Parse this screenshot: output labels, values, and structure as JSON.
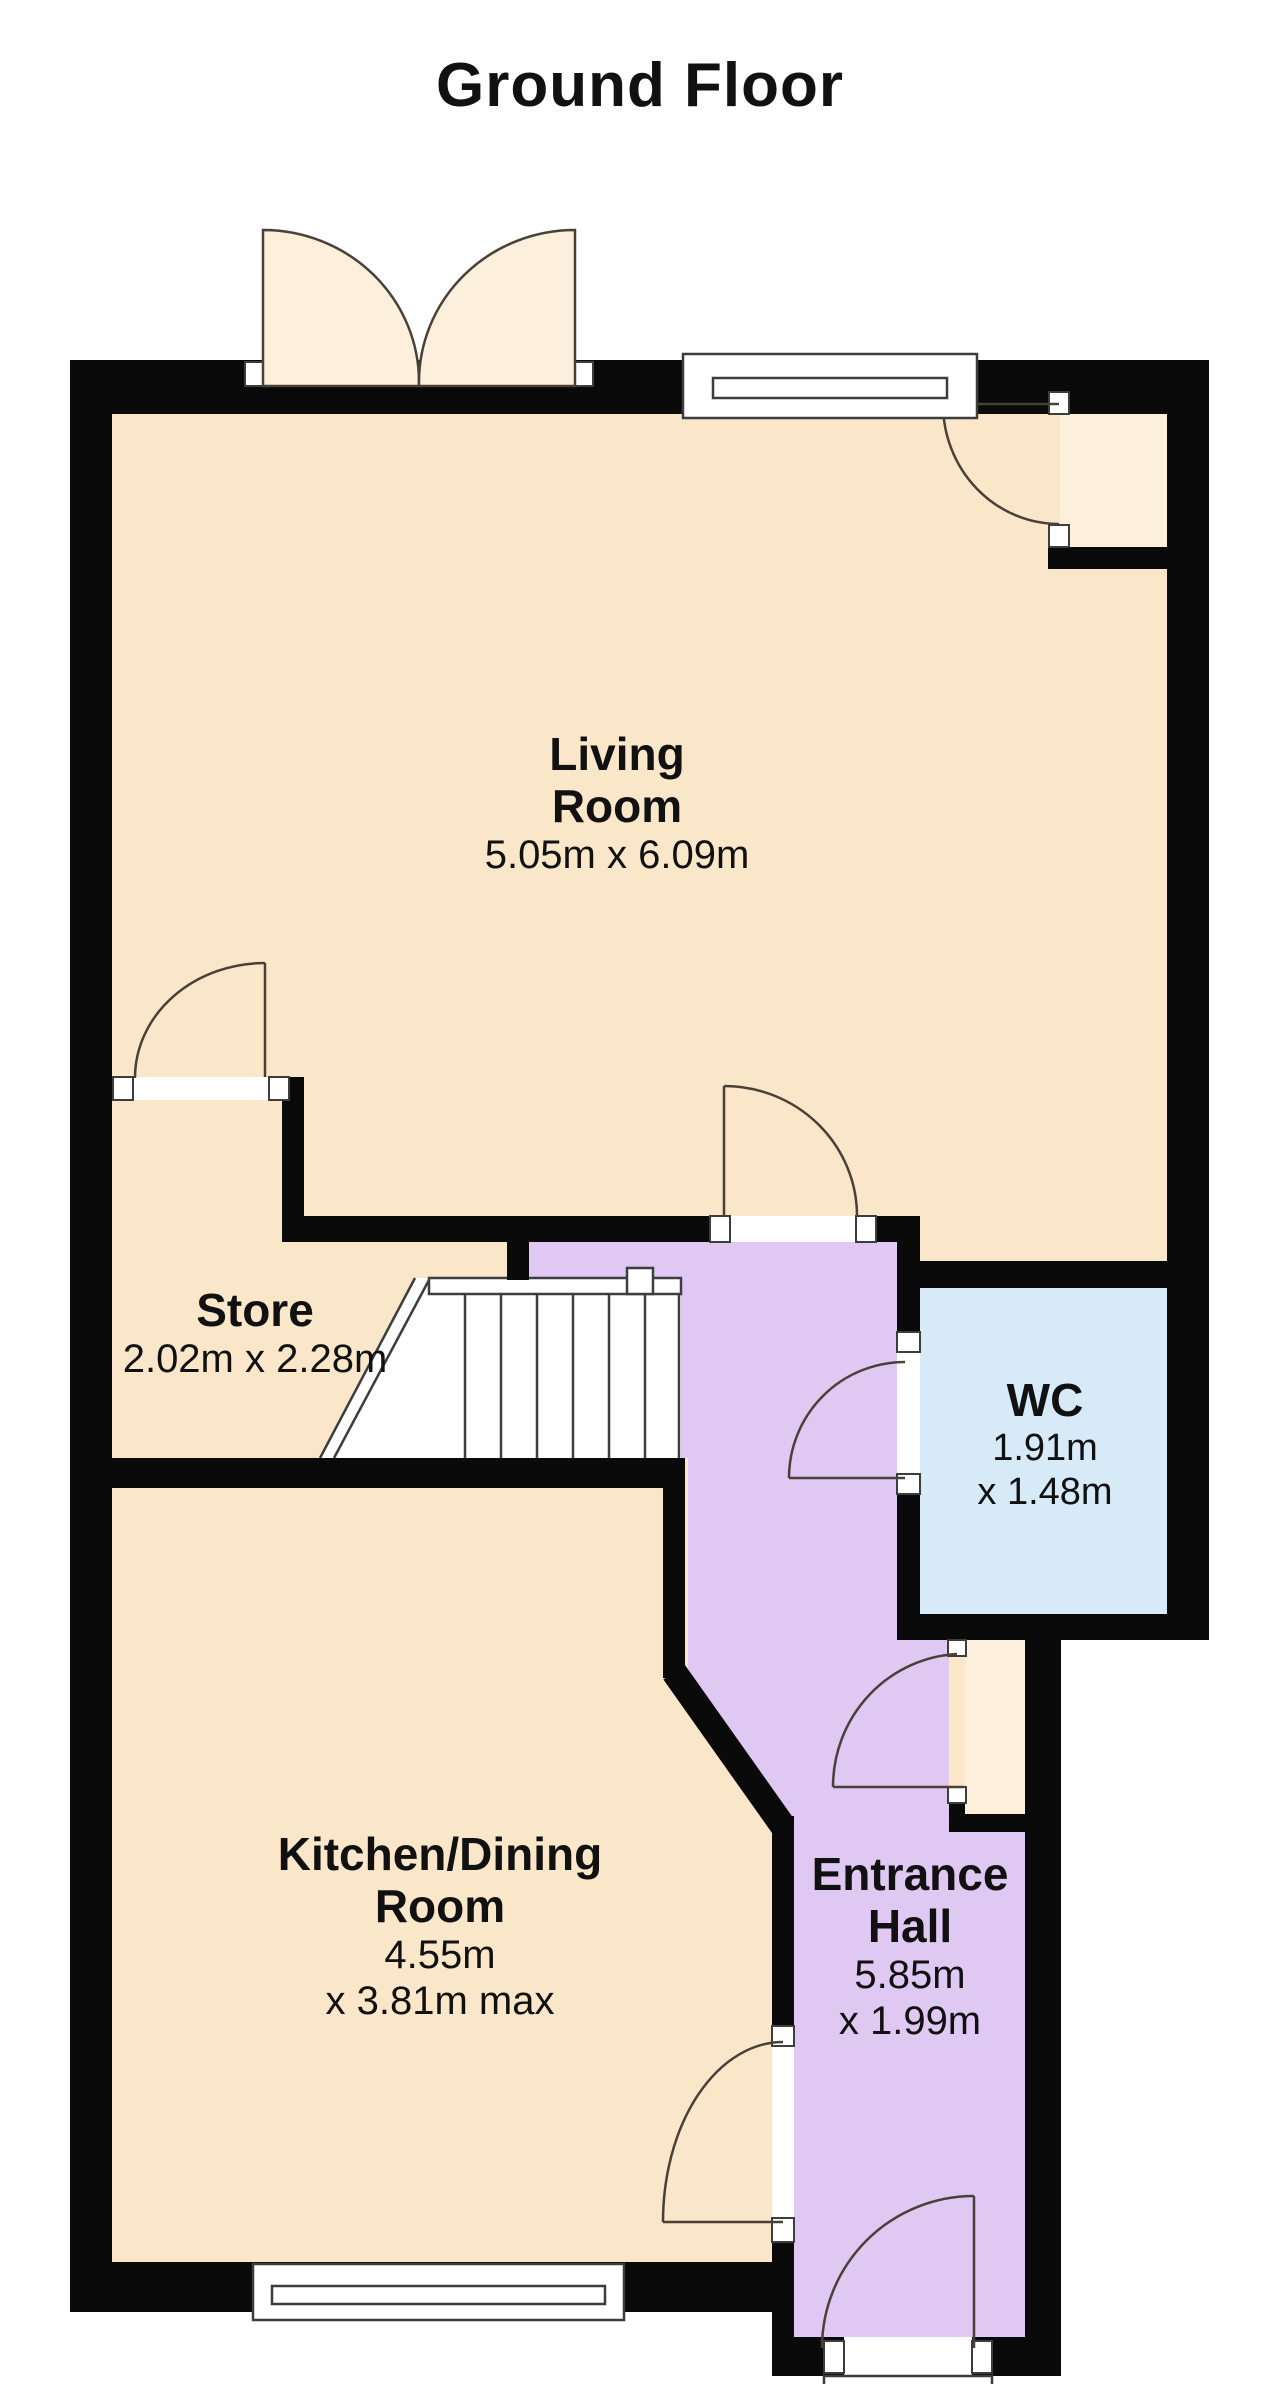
{
  "title": "Ground Floor",
  "rooms": {
    "living": {
      "name1": "Living",
      "name2": "Room",
      "dims1": "5.05m x 6.09m"
    },
    "store": {
      "name1": "Store",
      "dims1": "2.02m x 2.28m"
    },
    "wc": {
      "name1": "WC",
      "dims1": "1.91m",
      "dims2": "x 1.48m"
    },
    "kitchen": {
      "name1": "Kitchen/Dining",
      "name2": "Room",
      "dims1": "4.55m",
      "dims2": "x 3.81m max"
    },
    "hall": {
      "name1": "Entrance",
      "name2": "Hall",
      "dims1": "5.85m",
      "dims2": "x 1.99m"
    }
  },
  "colors": {
    "room_cream": "#FAE7C9",
    "swing_cream": "#FCF0DC",
    "hall_purple": "#DFC8F2",
    "wc_blue": "#D6EAF8",
    "wall_black": "#0a0a0a",
    "line_dark": "#4a4038",
    "white": "#ffffff"
  }
}
